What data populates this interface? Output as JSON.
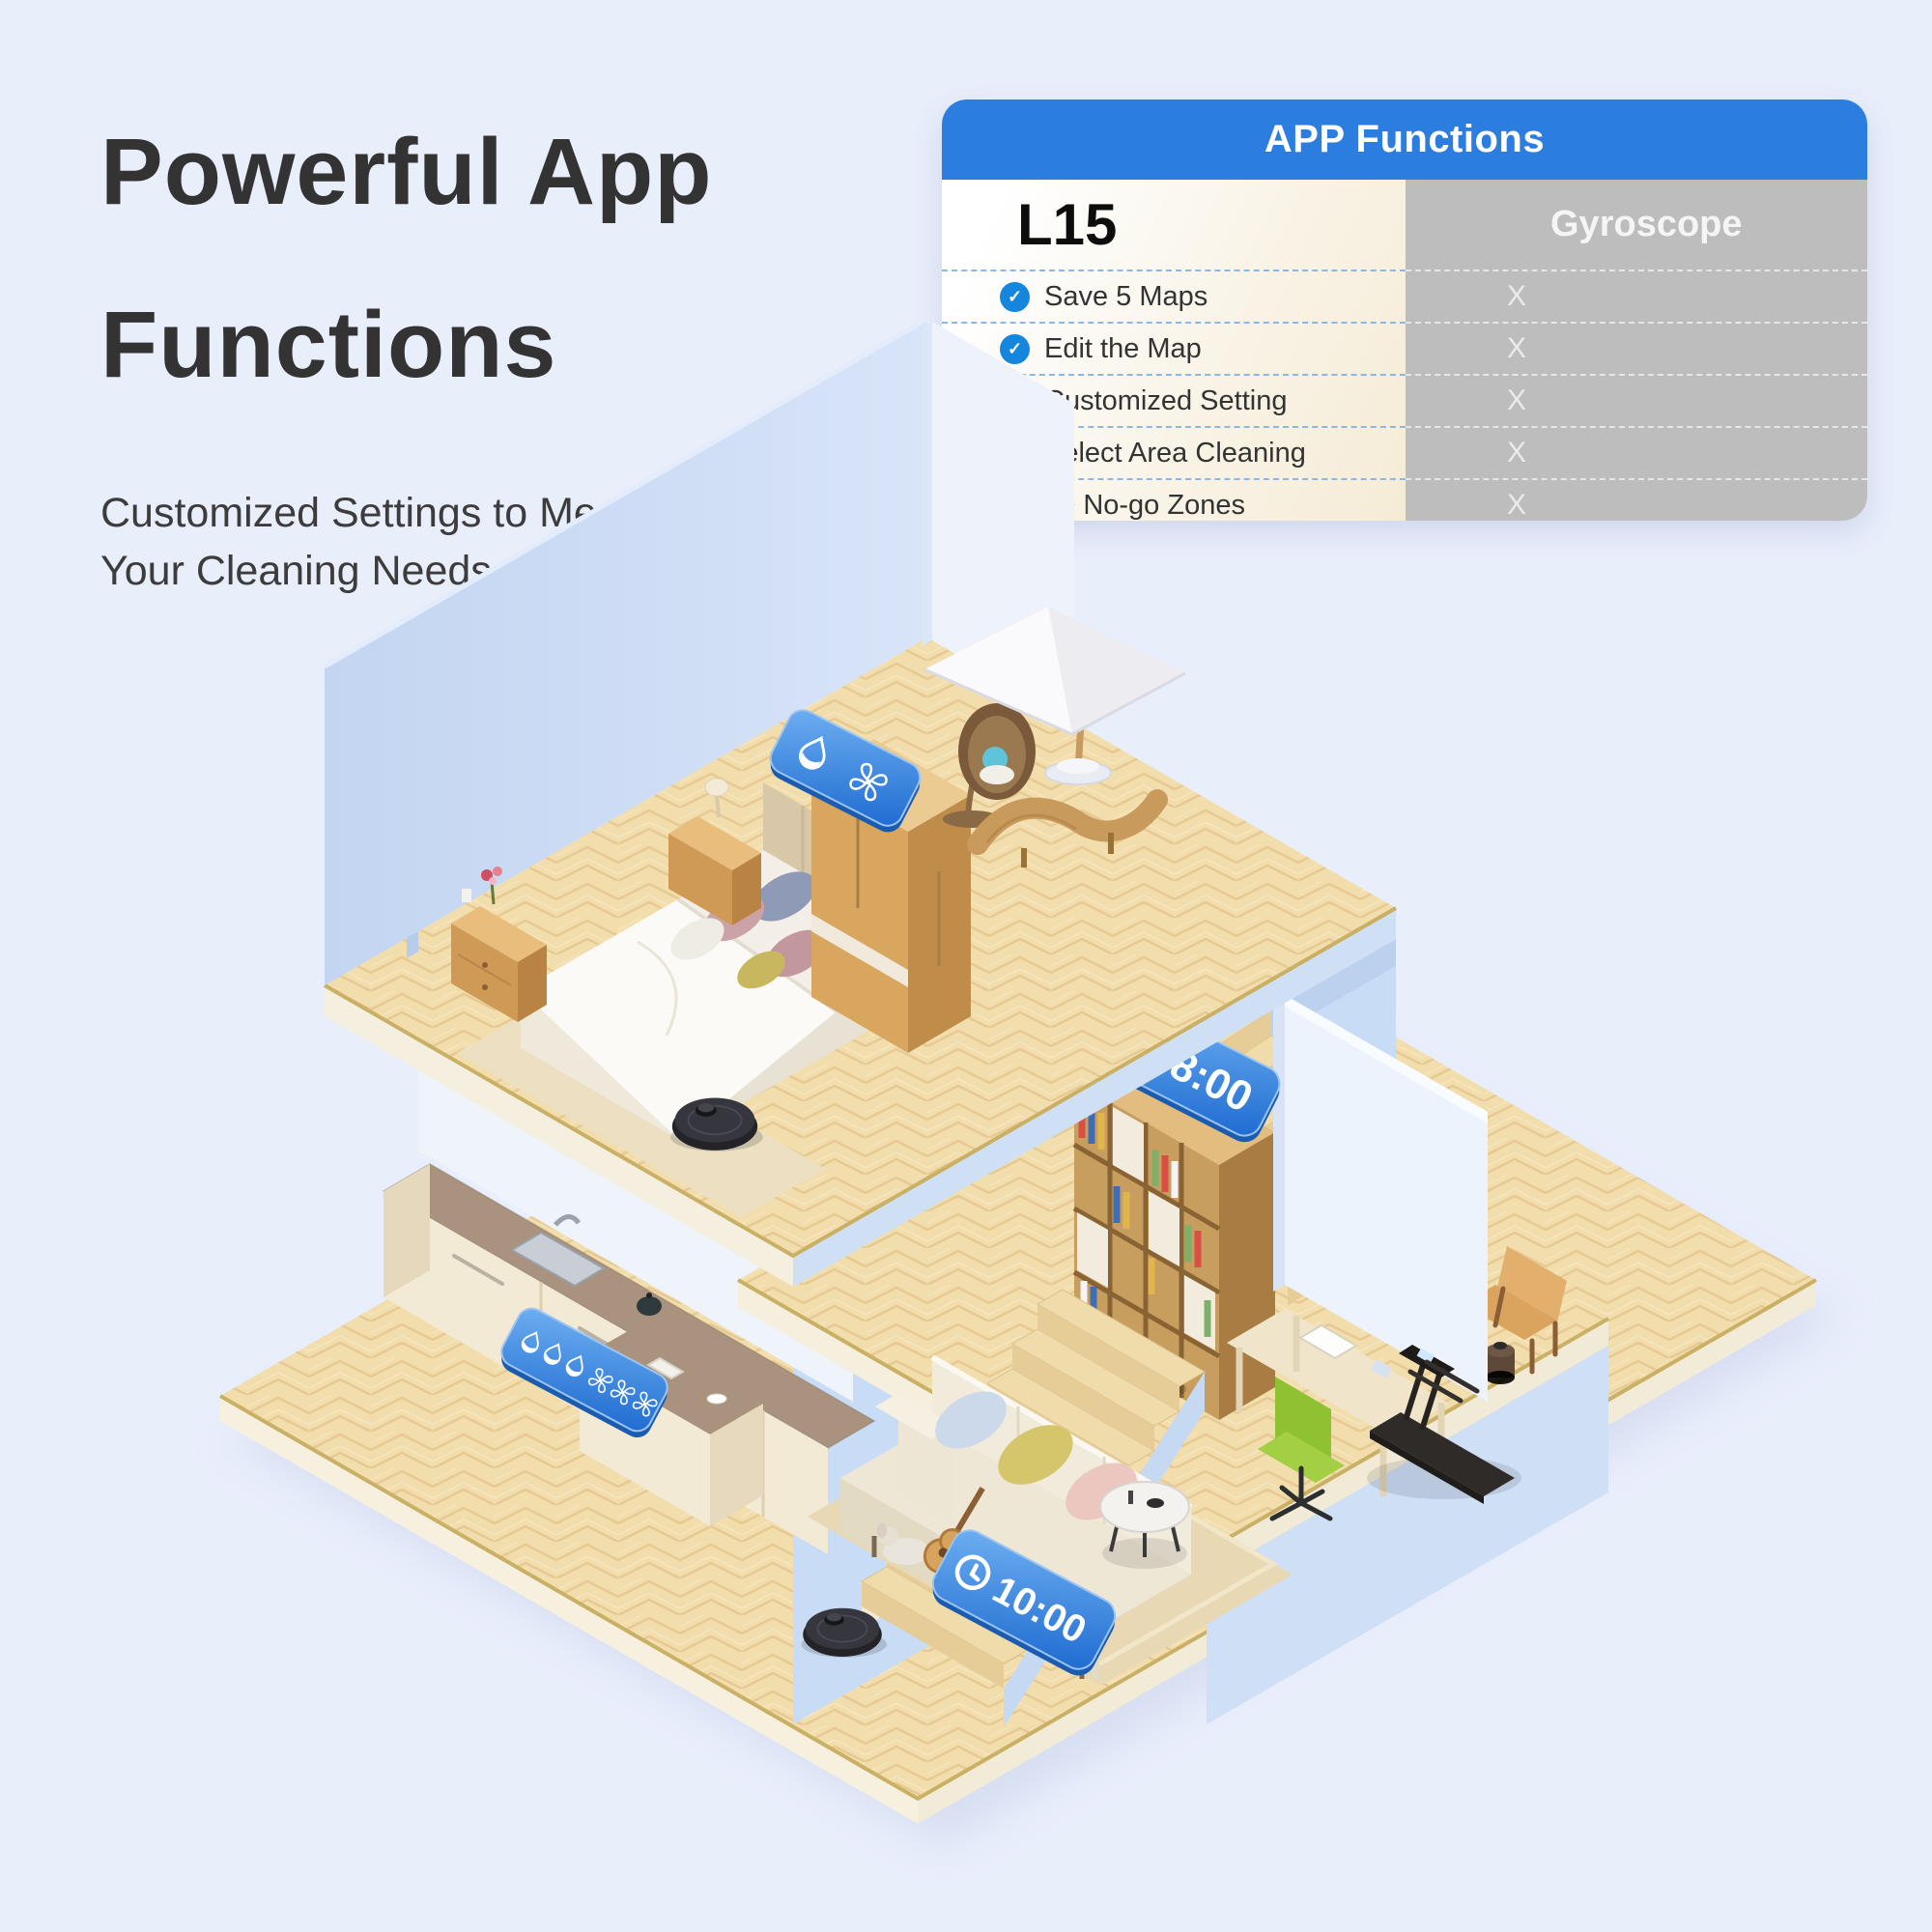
{
  "page": {
    "background": "#e9eefb"
  },
  "intro": {
    "title_line1": "Powerful App",
    "title_line2": "Functions",
    "subtitle_line1": "Customized Settings to Meet",
    "subtitle_line2": "Your Cleaning Needs"
  },
  "comparison_table": {
    "title": "APP Functions",
    "product_column": {
      "name": "L15"
    },
    "competitor_column": {
      "name": "Gyroscope"
    },
    "check_symbol": "✓",
    "rows": [
      {
        "feature": "Save 5 Maps",
        "product": "✓",
        "competitor": "X"
      },
      {
        "feature": "Edit the Map",
        "product": "✓",
        "competitor": "X"
      },
      {
        "feature": "Customized Setting",
        "product": "✓",
        "competitor": "X"
      },
      {
        "feature": "Select Area Cleaning",
        "product": "✓",
        "competitor": "X"
      },
      {
        "feature": "30 No-go Zones",
        "product": "✓",
        "competitor": "X"
      }
    ],
    "colors": {
      "header_bg": "#2b7de0",
      "header_text": "#ffffff",
      "product_bg": "#f8f1e2",
      "competitor_bg": "#bdbdbd",
      "check_bg": "#1486dd",
      "divider_left": "#8cb6e4",
      "divider_right": "#e6e6e6"
    }
  },
  "scene": {
    "badges": {
      "bedroom": {
        "icons": [
          "water-drop-icon",
          "fan-icon"
        ]
      },
      "kitchen": {
        "icons": [
          "water-drop-icon",
          "water-drop-icon",
          "water-drop-icon",
          "fan-icon",
          "fan-icon",
          "fan-icon"
        ]
      },
      "office_schedule": {
        "icon": "clock-icon",
        "time": "8:00"
      },
      "living_schedule": {
        "icon": "clock-icon",
        "time": "10:00"
      }
    },
    "robots": [
      {
        "location": "bedroom"
      },
      {
        "location": "office"
      },
      {
        "location": "living-room"
      }
    ],
    "accent_blue": "#2e7ce0"
  }
}
